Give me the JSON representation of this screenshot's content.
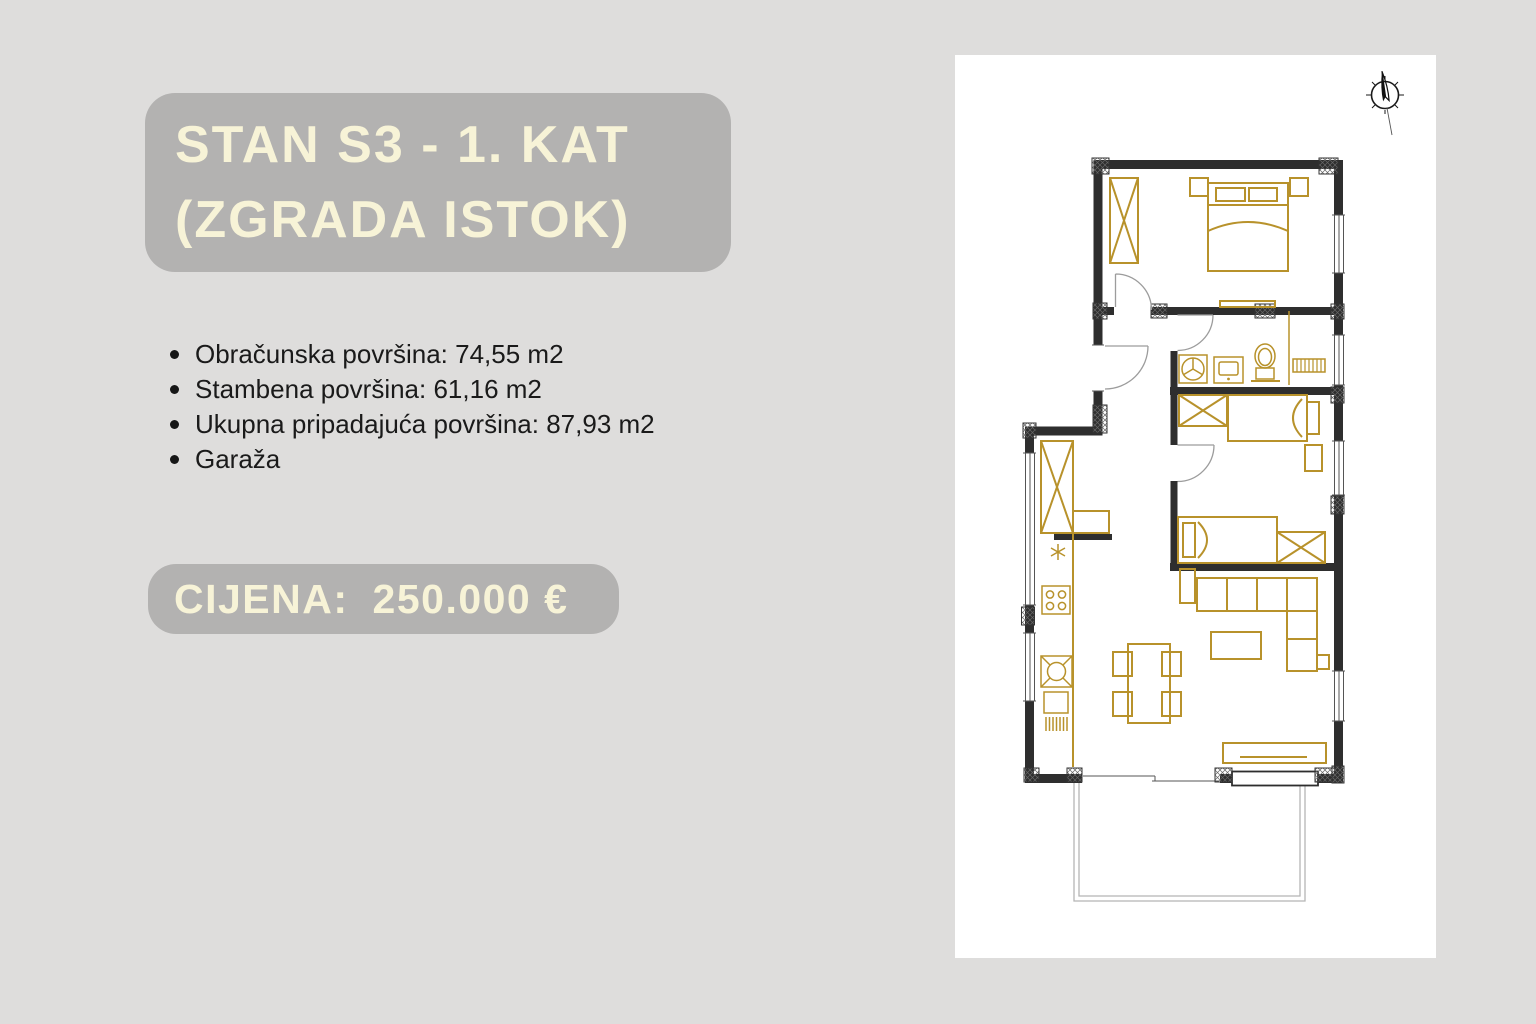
{
  "colors": {
    "page_bg": "#dedddc",
    "block_bg": "#b3b2b1",
    "cream": "#f7f3d7",
    "text_dark": "#1a1a1a",
    "plan_gold": "#b8922b",
    "plan_wall": "#2e2e2e",
    "plan_door": "#9c9c9c",
    "plan_gray": "#b5b5b5",
    "panel_bg": "#ffffff"
  },
  "listing": {
    "title_line1": "STAN S3 - 1. KAT",
    "title_line2": "(ZGRADA ISTOK)",
    "details": [
      "Obračunska površina: 74,55 m2",
      "Stambena površina: 61,16 m2",
      "Ukupna pripadajuća površina: 87,93 m2",
      "Garaža"
    ],
    "price_label": "CIJENA:",
    "price_value": "250.000 €"
  },
  "floorplan": {
    "compass_icon": "north-compass-icon"
  }
}
